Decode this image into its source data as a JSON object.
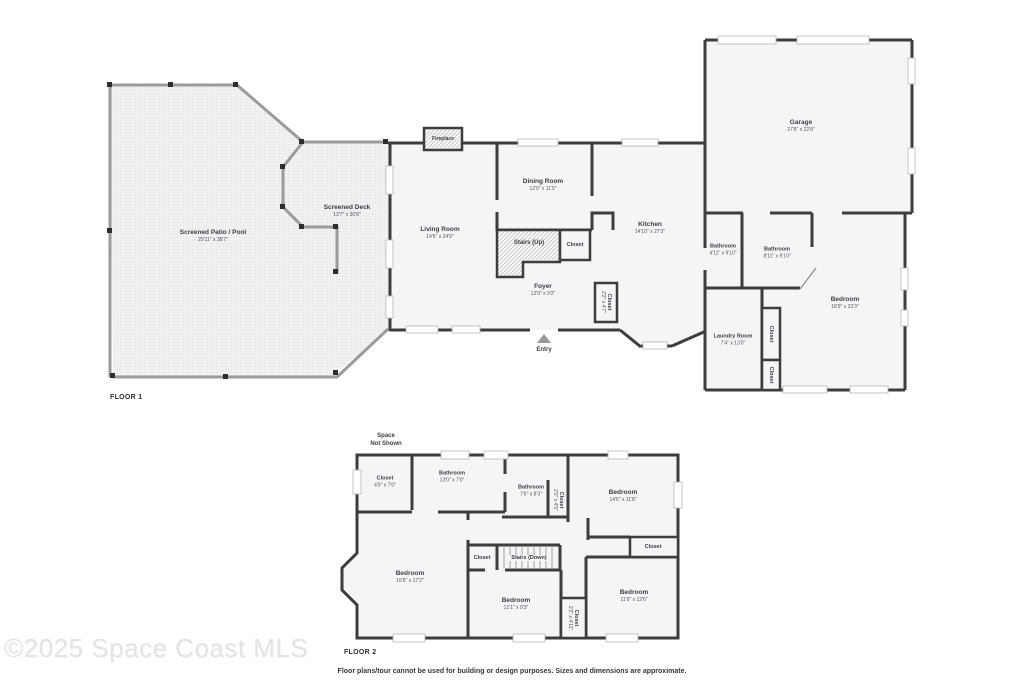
{
  "floor1": {
    "label": "FLOOR 1",
    "rooms": [
      {
        "name": "Screened Patio / Pool",
        "dims": "29'11\" x 38'7\""
      },
      {
        "name": "Screened Deck",
        "dims": "13'7\" x 30'8\""
      },
      {
        "name": "Living Room",
        "dims": "14'6\" x 24'9\""
      },
      {
        "name": "Dining Room",
        "dims": "12'0\" x 11'5\""
      },
      {
        "name": "Kitchen",
        "dims": "14'10\" x 27'3\""
      },
      {
        "name": "Foyer",
        "dims": "12'0\" x 9'2\""
      },
      {
        "name": "Garage",
        "dims": "27'8\" x 22'8\""
      },
      {
        "name": "Bathroom",
        "dims": "4'11\" x 9'10\""
      },
      {
        "name": "Bathroom",
        "dims": "8'11\" x 9'10\""
      },
      {
        "name": "Bedroom",
        "dims": "18'9\" x 23'3\""
      },
      {
        "name": "Laundry Room",
        "dims": "7'4\" x 13'0\""
      }
    ],
    "features": {
      "fireplace": "Fireplace",
      "stairs_up": "Stairs (Up)",
      "stair_closet": "Closet",
      "foyer_closet": {
        "name": "Closet",
        "dims": "2'2\" x 4'7\""
      },
      "hall_closet_1": "Closet",
      "hall_closet_2": "Closet",
      "entry": "Entry"
    }
  },
  "floor2": {
    "label": "FLOOR 2",
    "space_note_line1": "Space",
    "space_note_line2": "Not Shown",
    "rooms": [
      {
        "name": "Closet",
        "dims": "4'9\" x 7'0\""
      },
      {
        "name": "Bathroom",
        "dims": "13'0\" x 7'0\""
      },
      {
        "name": "Bathroom",
        "dims": "7'6\" x 8'3\""
      },
      {
        "name": "Bedroom",
        "dims": "14'6\" x 11'8\""
      },
      {
        "name": "Bedroom",
        "dims": "16'6\" x 17'2\""
      },
      {
        "name": "Bedroom",
        "dims": "12'1\" x 9'3\""
      },
      {
        "name": "Bedroom",
        "dims": "11'9\" x 12'6\""
      }
    ],
    "features": {
      "vert_closet_top": {
        "name": "Closet",
        "dims": "2'0\" x 4'5\""
      },
      "right_closet": "Closet",
      "stair_closet": "Closet",
      "stairs_down": "Stairs (Down)",
      "vert_closet_bottom": {
        "name": "Closet",
        "dims": "2'2\" x 4'11\""
      }
    }
  },
  "footer": {
    "watermark": "©2025 Space Coast MLS",
    "disclaimer": "Floor plans/tour cannot be used for building or design purposes. Sizes and dimensions are approximate.",
    "colors": {
      "wall": "#3d3d3d",
      "screen_wall": "#9b9b9b",
      "room_fill": "#f5f5f5"
    }
  }
}
